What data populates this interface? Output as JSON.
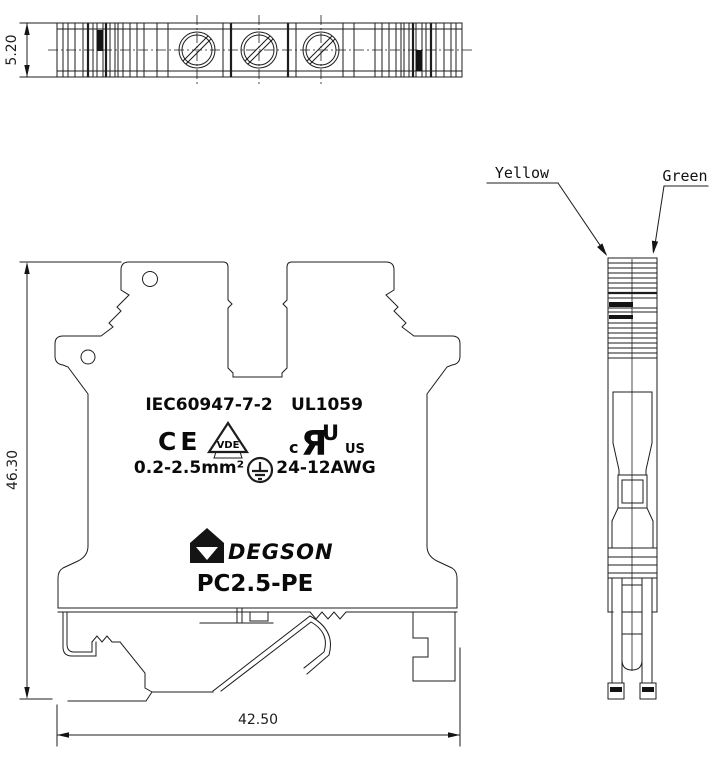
{
  "labels": {
    "yellow": "Yellow",
    "green": "Green"
  },
  "dimensions": {
    "thickness": "5.20",
    "height": "46.30",
    "width": "42.50"
  },
  "marking": {
    "iec": "IEC60947-7-2",
    "ul": "UL1059",
    "ce": "CE",
    "vde": "VDE",
    "wire_mm": "0.2-2.5mm²",
    "wire_awg": "24-12AWG",
    "ul_c": "c",
    "ul_monogram_r": "Я",
    "ul_monogram_u": "U",
    "ul_us": "US",
    "brand": "DEGSON",
    "model": "PC2.5-PE"
  },
  "colors": {
    "line": "#1d1d1d",
    "text": "#0a0a0a",
    "background": "#ffffff"
  }
}
